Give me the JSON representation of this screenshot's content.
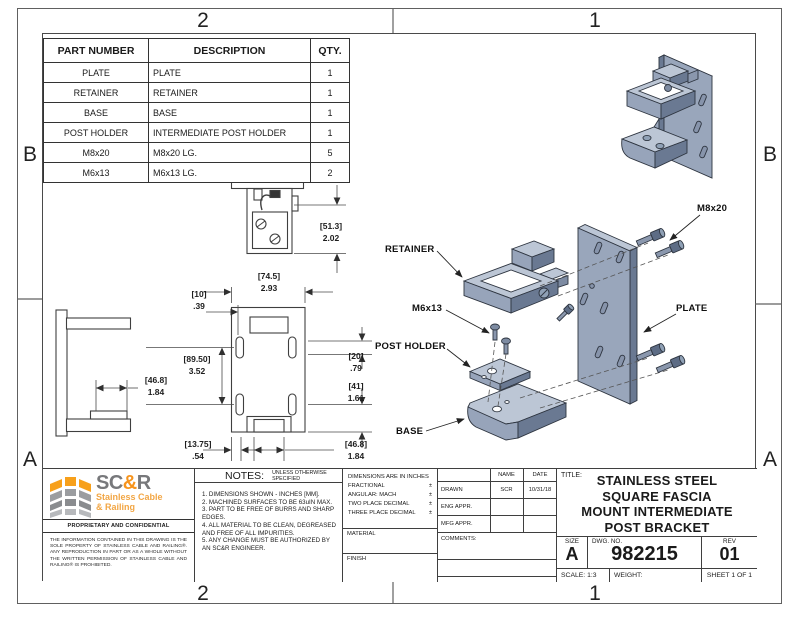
{
  "zones": {
    "col_left": "2",
    "col_right": "1",
    "row_top": "B",
    "row_bottom": "A"
  },
  "parts_table": {
    "headers": {
      "part_number": "PART NUMBER",
      "description": "DESCRIPTION",
      "qty": "QTY."
    },
    "rows": [
      {
        "part_number": "PLATE",
        "description": "PLATE",
        "qty": "1"
      },
      {
        "part_number": "RETAINER",
        "description": "RETAINER",
        "qty": "1"
      },
      {
        "part_number": "BASE",
        "description": "BASE",
        "qty": "1"
      },
      {
        "part_number": "POST HOLDER",
        "description": "INTERMEDIATE POST HOLDER",
        "qty": "1"
      },
      {
        "part_number": "M8x20",
        "description": "M8x20 LG.",
        "qty": "5"
      },
      {
        "part_number": "M6x13",
        "description": "M6x13 LG.",
        "qty": "2"
      }
    ]
  },
  "dimensions": {
    "height_51": {
      "mm": "[51.3]",
      "in": "2.02"
    },
    "width_74": {
      "mm": "[74.5]",
      "in": "2.93"
    },
    "offset_10": {
      "mm": "[10]",
      "in": ".39"
    },
    "height_89": {
      "mm": "[89.50]",
      "in": "3.52"
    },
    "offset_20": {
      "mm": "[20]",
      "in": ".79"
    },
    "offset_41": {
      "mm": "[41]",
      "in": "1.61"
    },
    "offset_13": {
      "mm": "[13.75]",
      "in": ".54"
    },
    "width_46_front": {
      "mm": "[46.8]",
      "in": "1.84"
    },
    "width_46_side": {
      "mm": "[46.8]",
      "in": "1.84"
    }
  },
  "exploded_labels": {
    "retainer": "RETAINER",
    "m6x13": "M6x13",
    "post_holder": "POST HOLDER",
    "base": "BASE",
    "m8x20": "M8x20",
    "plate": "PLATE"
  },
  "logo": {
    "sc": "SC",
    "amp": "&",
    "r": "R",
    "line1": "Stainless Cable",
    "line2": "& Railing",
    "proprietary": "PROPRIETARY AND CONFIDENTIAL",
    "disclaimer": "THE INFORMATION CONTAINED IN THIS DRAWING IS THE SOLE PROPERTY OF STAINLESS CABLE AND RAILING®. ANY REPRODUCTION IN PART OR AS A WHOLE WITHOUT THE WRITTEN PERMISSION OF STAINLESS CABLE AND RAILING® IS PROHIBITED."
  },
  "notes": {
    "title": "NOTES:",
    "subtitle": "UNLESS OTHERWISE SPECIFIED",
    "items": [
      "1. DIMENSIONS SHOWN - INCHES [MM].",
      "2. MACHINED SURFACES TO BE 63uIN MAX.",
      "3. PART TO BE FREE OF BURRS AND SHARP EDGES.",
      "4. ALL MATERIAL TO BE CLEAN, DEGREASED AND FREE OF ALL IMPURITIES.",
      "5. ANY CHANGE MUST BE AUTHORIZED BY AN SC&R ENGINEER."
    ]
  },
  "tolerances": {
    "heading": "DIMENSIONS ARE IN INCHES",
    "rows": [
      {
        "label": "FRACTIONAL",
        "pm": "±"
      },
      {
        "label": "ANGULAR: MACH",
        "pm": "±"
      },
      {
        "label": "TWO PLACE DECIMAL",
        "pm": "±"
      },
      {
        "label": "THREE PLACE DECIMAL",
        "pm": "±"
      }
    ],
    "material_label": "MATERIAL",
    "finish_label": "FINISH"
  },
  "approvals": {
    "name_header": "NAME",
    "date_header": "DATE",
    "rows": [
      {
        "label": "DRAWN",
        "name": "SCR",
        "date": "10/31/18"
      },
      {
        "label": "ENG APPR.",
        "name": "",
        "date": ""
      },
      {
        "label": "MFG APPR.",
        "name": "",
        "date": ""
      }
    ],
    "comments_label": "COMMENTS:"
  },
  "title_block": {
    "title_label": "TITLE:",
    "title_line1": "STAINLESS STEEL",
    "title_line2": "SQUARE FASCIA",
    "title_line3": "MOUNT INTERMEDIATE",
    "title_line4": "POST BRACKET",
    "size_label": "SIZE",
    "size_value": "A",
    "dwg_label": "DWG.  NO.",
    "dwg_value": "982215",
    "rev_label": "REV",
    "rev_value": "01",
    "scale_text": "SCALE: 1:3",
    "weight_text": "WEIGHT:",
    "sheet_text": "SHEET 1 OF 1"
  },
  "colors": {
    "logo_orange": "#F7941D",
    "logo_gray": "#8A8C8F",
    "part_face": "#99A6BB",
    "part_light": "#BCC6D5",
    "part_dark": "#6A7992",
    "line": "#3F3F3F"
  }
}
